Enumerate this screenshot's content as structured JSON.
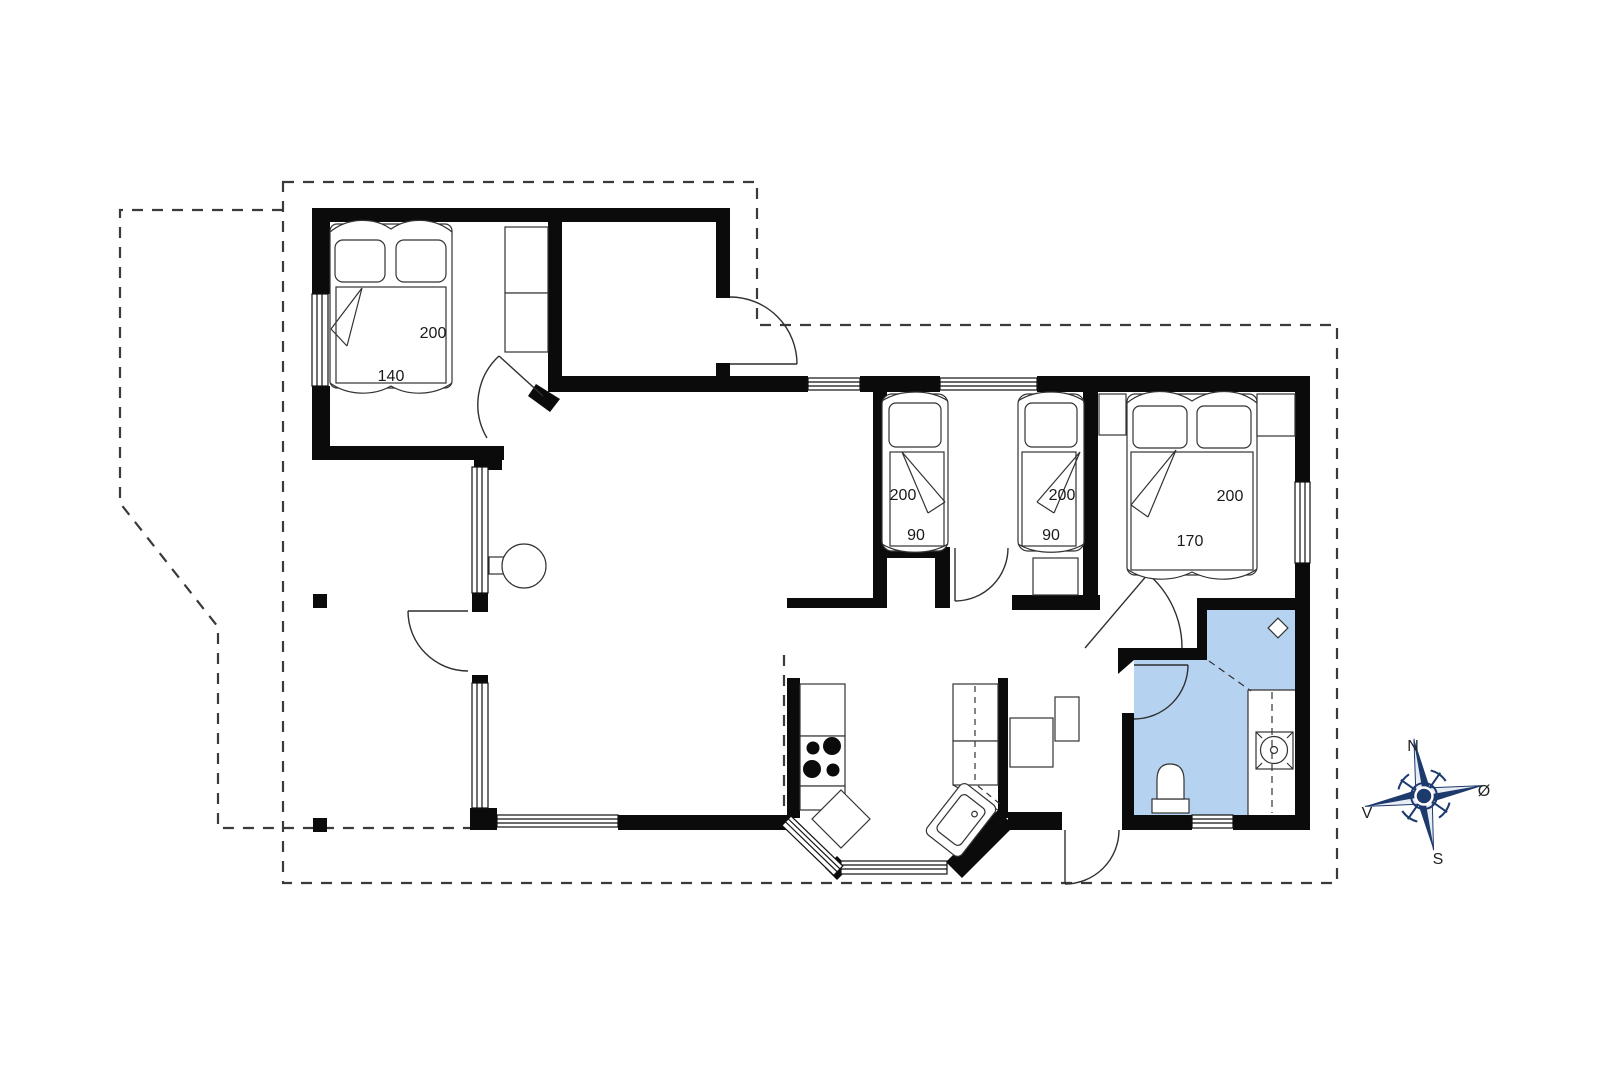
{
  "plan": {
    "type": "floor-plan",
    "dimension_labels": {
      "master_bed": {
        "length": "200",
        "width": "140"
      },
      "single_bed_left": {
        "length": "200",
        "width": "90"
      },
      "single_bed_right": {
        "length": "200",
        "width": "90"
      },
      "double_bed": {
        "length": "200",
        "width": "170"
      }
    },
    "compass": {
      "north": "N",
      "south": "S",
      "west": "V",
      "east": "Ø"
    },
    "colors": {
      "wall": "#0b0b0b",
      "bathroom_fill": "#b6d2f1",
      "compass_navy": "#1d3a6d",
      "thin_line": "#2f2f2f"
    }
  }
}
